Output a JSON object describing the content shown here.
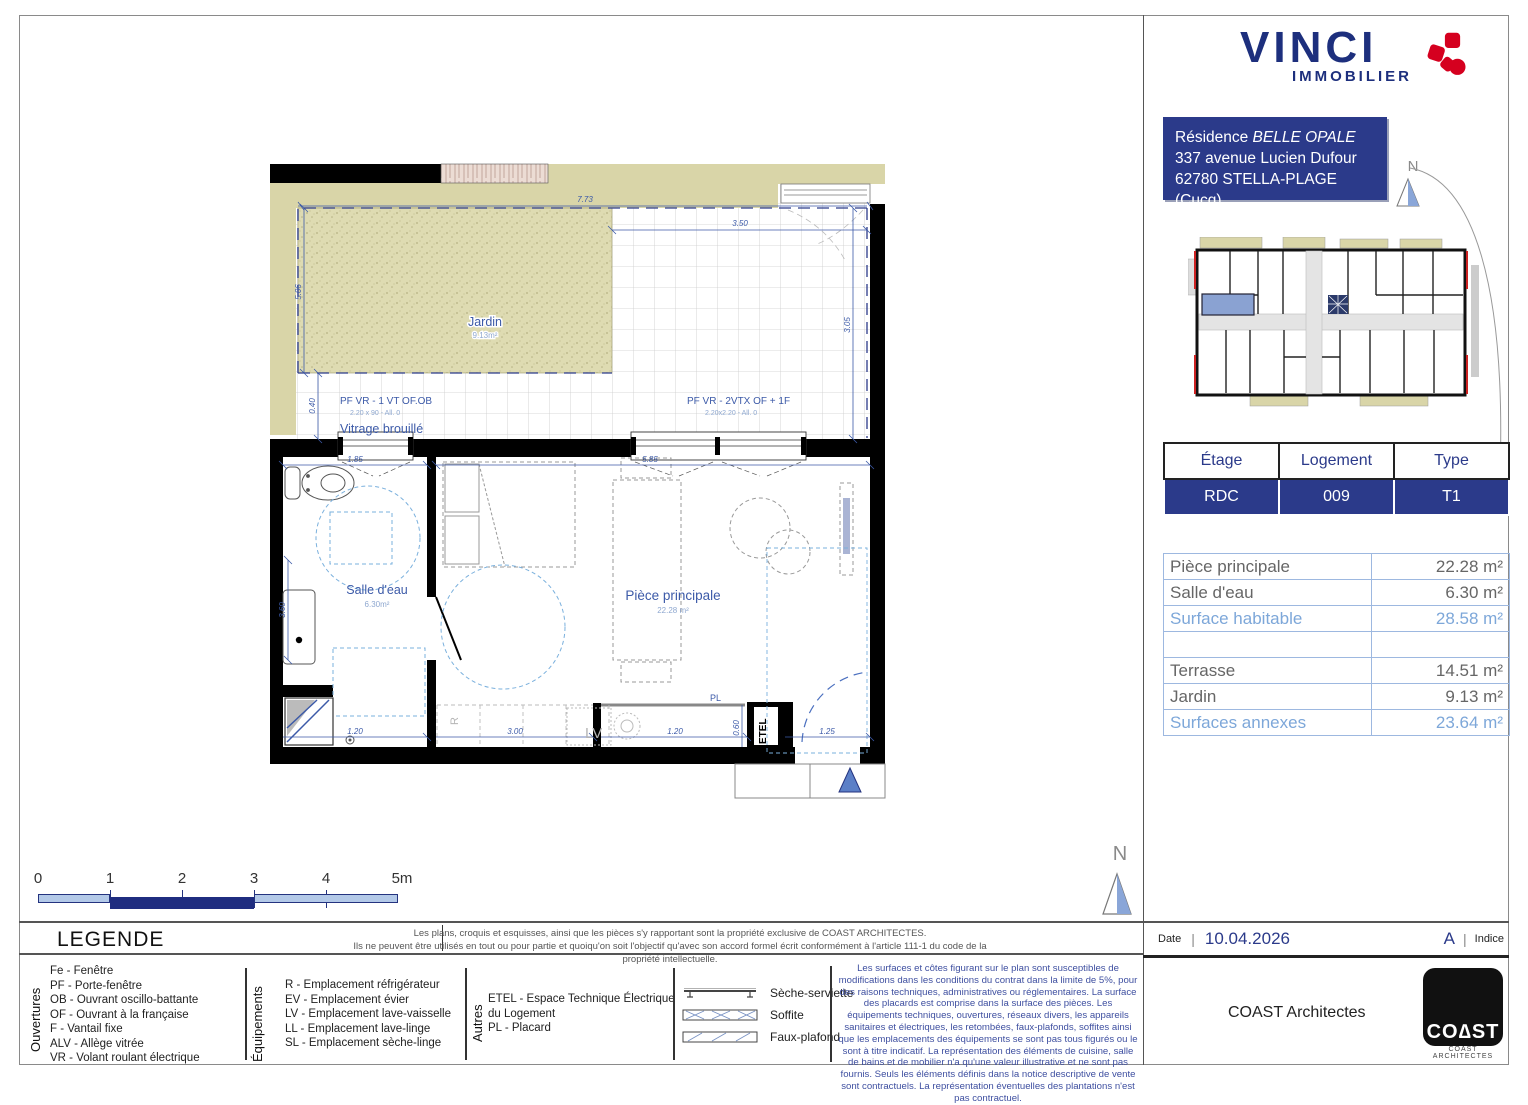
{
  "brand": {
    "name": "VINCI",
    "division": "IMMOBILIER"
  },
  "project": {
    "residence_prefix": "Résidence ",
    "residence_name": "BELLE OPALE",
    "address_line1": "337 avenue Lucien Dufour",
    "address_line2": "62780 STELLA-PLAGE (Cucq)"
  },
  "north": {
    "label": "N"
  },
  "unit_table": {
    "col1": "Étage",
    "col2": "Logement",
    "col3": "Type",
    "val1": "RDC",
    "val2": "009",
    "val3": "T1"
  },
  "areas": {
    "r1l": "Pièce principale",
    "r1v": "22.28 m²",
    "r2l": "Salle d'eau",
    "r2v": "6.30 m²",
    "r3l": "Surface habitable",
    "r3v": "28.58 m²",
    "r5l": "Terrasse",
    "r5v": "14.51 m²",
    "r6l": "Jardin",
    "r6v": "9.13 m²",
    "r7l": "Surfaces annexes",
    "r7v": "23.64 m²"
  },
  "plan": {
    "jardin_label": "Jardin",
    "jardin_area": "9.13m²",
    "salle_label": "Salle d'eau",
    "salle_area": "6.30m²",
    "piece_label": "Pièce principale",
    "piece_area": "22.28 m²",
    "window1_label": "PF VR - 1 VT OF.OB",
    "window1_dims": "2.20 x 90 - All. 0",
    "window1_note": "Vitrage brouillé",
    "window2_label": "PF VR - 2VTX OF + 1F",
    "window2_dims": "2.20x2.20 - All. 0",
    "pl": "PL",
    "etel": "ETEL",
    "lv": "LV",
    "r": "R",
    "dim_top": "7.73",
    "dim_top2": "3.50",
    "dim_left": "5.06",
    "dim_left2": "0.40",
    "dim_salle": "3.60",
    "dim_right": "3.05",
    "dim_int1": "1.85",
    "dim_int2": "5.85",
    "dim_b1": "1.20",
    "dim_b2": "3.00",
    "dim_b3": "1.20",
    "dim_b4": "0.60",
    "dim_b5": "1.25"
  },
  "scalebar": {
    "t0": "0",
    "t1": "1",
    "t2": "2",
    "t3": "3",
    "t4": "4",
    "t5": "5m"
  },
  "legend": {
    "title": "LEGENDE",
    "group1": "Ouvertures",
    "g1": [
      "Fe - Fenêtre",
      "PF - Porte-fenêtre",
      "OB - Ouvrant oscillo-battante",
      "OF - Ouvrant à la française",
      "F - Vantail fixe",
      "ALV - Allège vitrée",
      "VR - Volant roulant électrique"
    ],
    "group2": "Équipements",
    "g2": [
      "R - Emplacement réfrigérateur",
      "EV - Emplacement évier",
      "LV - Emplacement lave-vaisselle",
      "LL - Emplacement lave-linge",
      "SL - Emplacement sèche-linge"
    ],
    "group3": "Autres",
    "g3_line1": "ETEL - Espace Technique Électrique",
    "g3_line2": "du Logement",
    "g3_line3": "PL - Placard",
    "sym1": "Sèche-serviette",
    "sym2": "Soffite",
    "sym3": "Faux-plafond"
  },
  "copyright": {
    "line1": "Les plans, croquis et esquisses, ainsi que les pièces s'y rapportant sont la propriété exclusive de COAST ARCHITECTES.",
    "line2": "Ils ne peuvent être utilisés en tout ou pour partie et quoiqu'on soit l'objectif qu'avec son accord formel écrit conformément à l'article 111-1 du code de la propriété intellectuelle."
  },
  "disclaimer": "Les surfaces et côtes figurant sur le plan sont susceptibles de modifications dans les conditions du contrat dans la limite de 5%, pour des raisons techniques, administratives ou réglementaires. La surface des placards est comprise dans la surface des pièces. Les équipements techniques, ouvertures, réseaux divers, les appareils sanitaires et électriques, les retombées, faux-plafonds, soffites ainsi que les emplacements des équipements se sont pas tous figurés ou le sont à titre indicatif. La représentation des éléments de cuisine, salle de bains et de mobilier n'a qu'une valeur illustrative et ne sont pas fournis. Seuls les éléments définis dans la notice descriptive de vente sont contractuels. La représentation éventuelles des plantations n'est pas contractuel.",
  "footer": {
    "date_label": "Date",
    "date_value": "10.04.2026",
    "indice_value": "A",
    "indice_label": "Indice",
    "architect": "COAST Architectes",
    "logo_big": "CO∆ST",
    "logo_small": "COAST ARCHITECTES"
  },
  "colors": {
    "navy": "#2b3a8a",
    "light_blue": "#7da7d9",
    "plan_blue": "#3c5aa8",
    "beige": "#d9d5a8",
    "red": "#d5001f"
  }
}
